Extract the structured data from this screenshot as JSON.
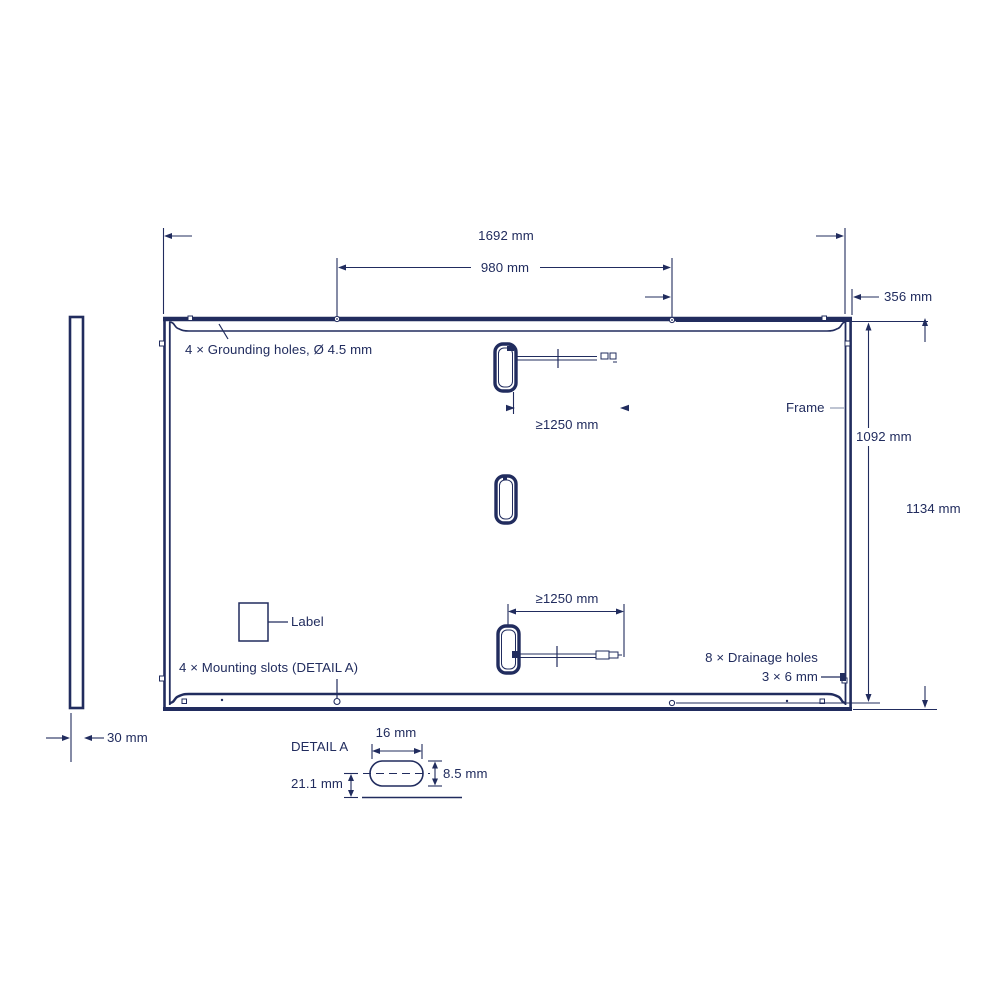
{
  "colors": {
    "ink": "#212c5e",
    "leader_gray": "#a8b0c2",
    "background": "#ffffff"
  },
  "panel_rear_view": {
    "labels": {
      "grounding_holes": "4 × Grounding holes, Ø 4.5 mm",
      "frame": "Frame",
      "label": "Label",
      "mounting_slots": "4 × Mounting slots (DETAIL A)",
      "drainage_holes_line1": "8 × Drainage holes",
      "drainage_holes_line2": "3 × 6 mm"
    },
    "dimensions": {
      "overall_width": "1692 mm",
      "mounting_slot_spacing": "980 mm",
      "edge_to_slot": "356 mm",
      "inner_height": "1092 mm",
      "overall_height": "1134 mm",
      "clamp_min_top": "≥1250 mm",
      "clamp_min_bottom": "≥1250 mm"
    }
  },
  "side_profile_view": {
    "dimensions": {
      "thickness": "30 mm"
    }
  },
  "detail_a": {
    "title": "DETAIL A",
    "dimensions": {
      "slot_width": "16 mm",
      "slot_height": "8.5 mm",
      "slot_offset": "21.1 mm"
    }
  }
}
